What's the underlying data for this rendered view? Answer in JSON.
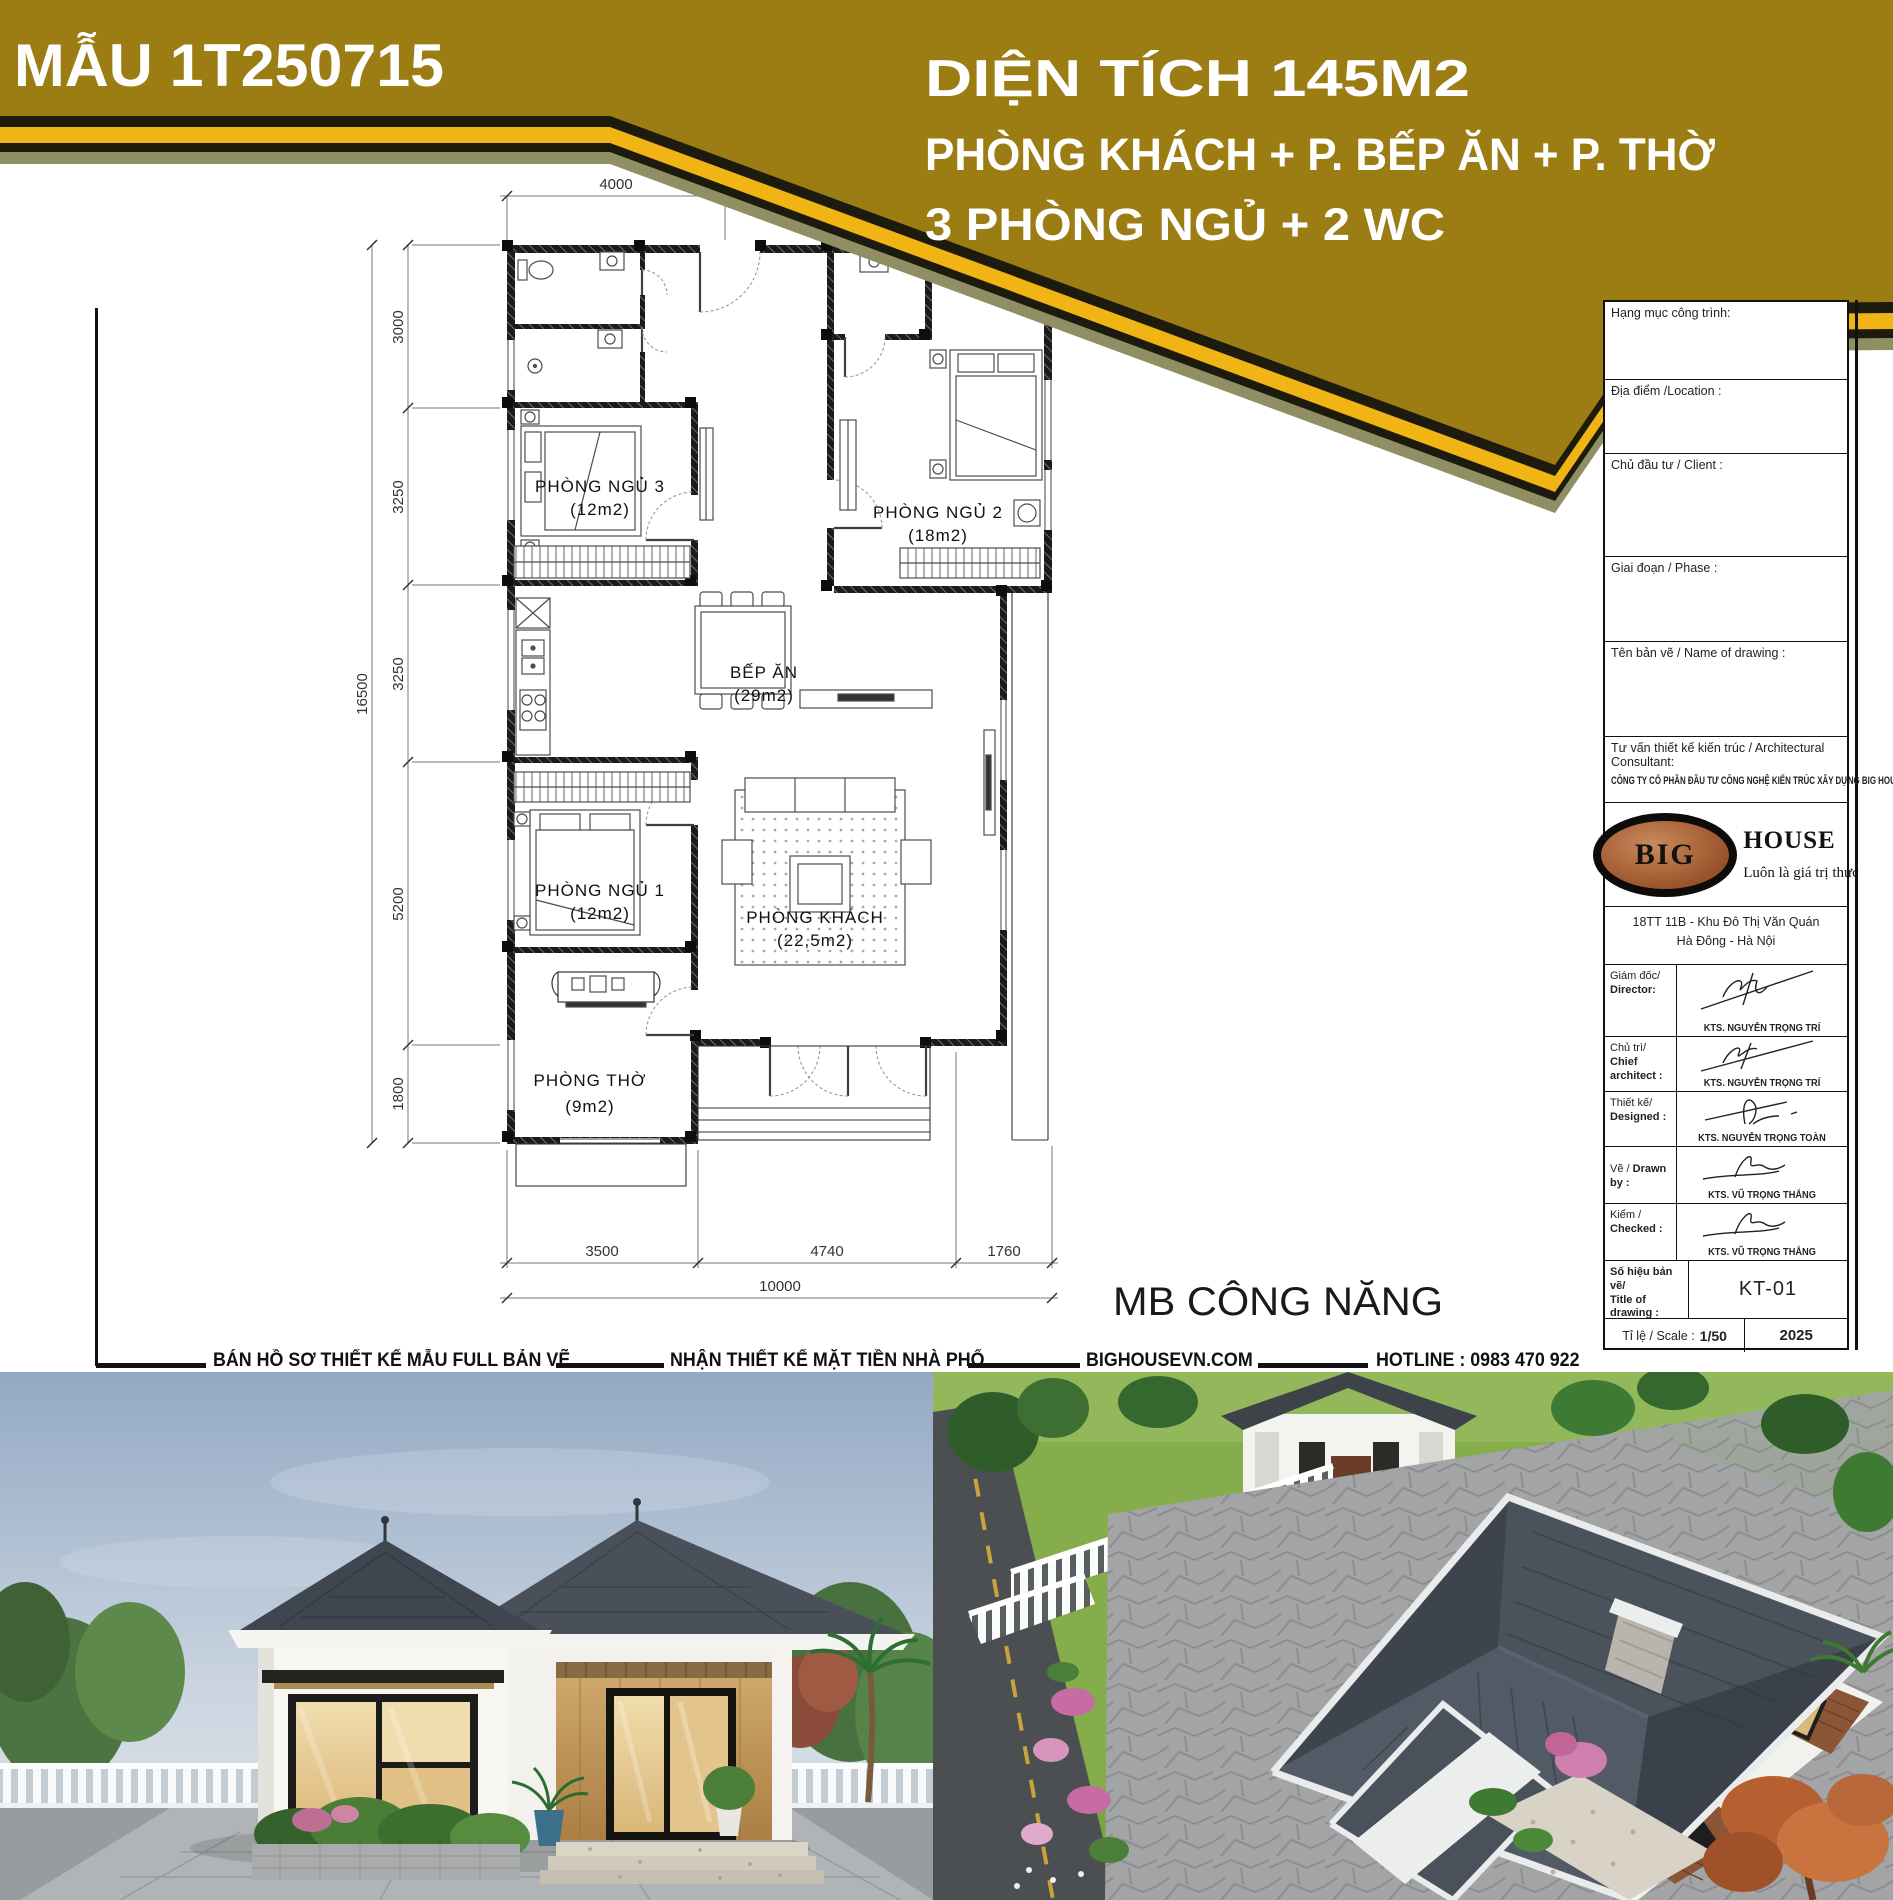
{
  "header": {
    "model_label": "MẪU 1T250715",
    "area_line": "DIỆN TÍCH 145M2",
    "program_line1": "PHÒNG KHÁCH + P. BẾP ĂN + P. THỜ",
    "program_line2": "3 PHÒNG NGỦ + 2 WC",
    "colors": {
      "gold": "#9c7d13",
      "stripe_yellow": "#f0b414",
      "stripe_black": "#1d1a0e",
      "shadow_olive": "#8f8f63"
    }
  },
  "plan": {
    "caption": "MB CÔNG NĂNG",
    "rooms": [
      {
        "name": "PHÒNG NGỦ 3",
        "area": "(12m2)"
      },
      {
        "name": "PHÒNG NGỦ 2",
        "area": "(18m2)"
      },
      {
        "name": "BẾP ĂN",
        "area": "(29m2)"
      },
      {
        "name": "PHÒNG NGỦ 1",
        "area": "(12m2)"
      },
      {
        "name": "PHÒNG KHÁCH",
        "area": "(22,5m2)"
      },
      {
        "name": "PHÒNG THỜ",
        "area": "(9m2)"
      }
    ],
    "dims": {
      "top": "4000",
      "left": [
        "3000",
        "3250",
        "3250",
        "5200",
        "1800"
      ],
      "left_total": "16500",
      "bottom": [
        "3500",
        "4740",
        "1760"
      ],
      "bottom_total": "10000"
    }
  },
  "title_block": {
    "fields": [
      "Hạng mục công trình:",
      "Địa điểm /Location :",
      "Chủ đầu tư / Client :",
      "Giai đoạn / Phase :",
      "Tên bản vẽ / Name of drawing :"
    ],
    "consultant_label": "Tư vấn thiết kế kiến trúc / Architectural Consultant:",
    "company": "CÔNG TY CỔ PHẦN ĐẦU TƯ CÔNG NGHỆ KIẾN TRÚC XÂY DỰNG BIG HOUSE",
    "logo": {
      "big": "BIG",
      "house": "HOUSE",
      "tagline": "Luôn là giá trị thực"
    },
    "address_line1": "18TT 11B - Khu Đô Thị Văn Quán",
    "address_line2": "Hà Đông - Hà Nội",
    "signatures": [
      {
        "label1": "Giám đốc/",
        "label2": "Director:",
        "name": "KTS. NGUYỄN TRỌNG TRÍ"
      },
      {
        "label1": "Chủ trì/",
        "label2": "Chief architect :",
        "name": "KTS. NGUYỄN TRỌNG TRÍ"
      },
      {
        "label1": "Thiết kế/",
        "label2": "Designed :",
        "name": "KTS. NGUYỄN TRỌNG TOÀN"
      },
      {
        "label1": "Vẽ /",
        "label2": "Drawn by :",
        "name": "KTS. VŨ TRỌNG THẮNG"
      },
      {
        "label1": "Kiểm /",
        "label2": "Checked :",
        "name": "KTS. VŨ TRỌNG THẮNG"
      }
    ],
    "drawing_no": {
      "label1": "Số hiệu bản vẽ/",
      "label2": "Title of drawing :",
      "value": "KT-01"
    },
    "scale_row": {
      "label": "Tỉ lệ / Scale :",
      "value": "1/50",
      "year": "2025"
    }
  },
  "footer": {
    "item1": "BÁN HỒ SƠ THIẾT KẾ MẪU FULL BẢN VẼ",
    "item2": "NHẬN THIẾT KẾ MẶT TIỀN NHÀ PHỐ",
    "item3": "BIGHOUSEVN.COM",
    "item4": "HOTLINE : 0983 470 922"
  }
}
